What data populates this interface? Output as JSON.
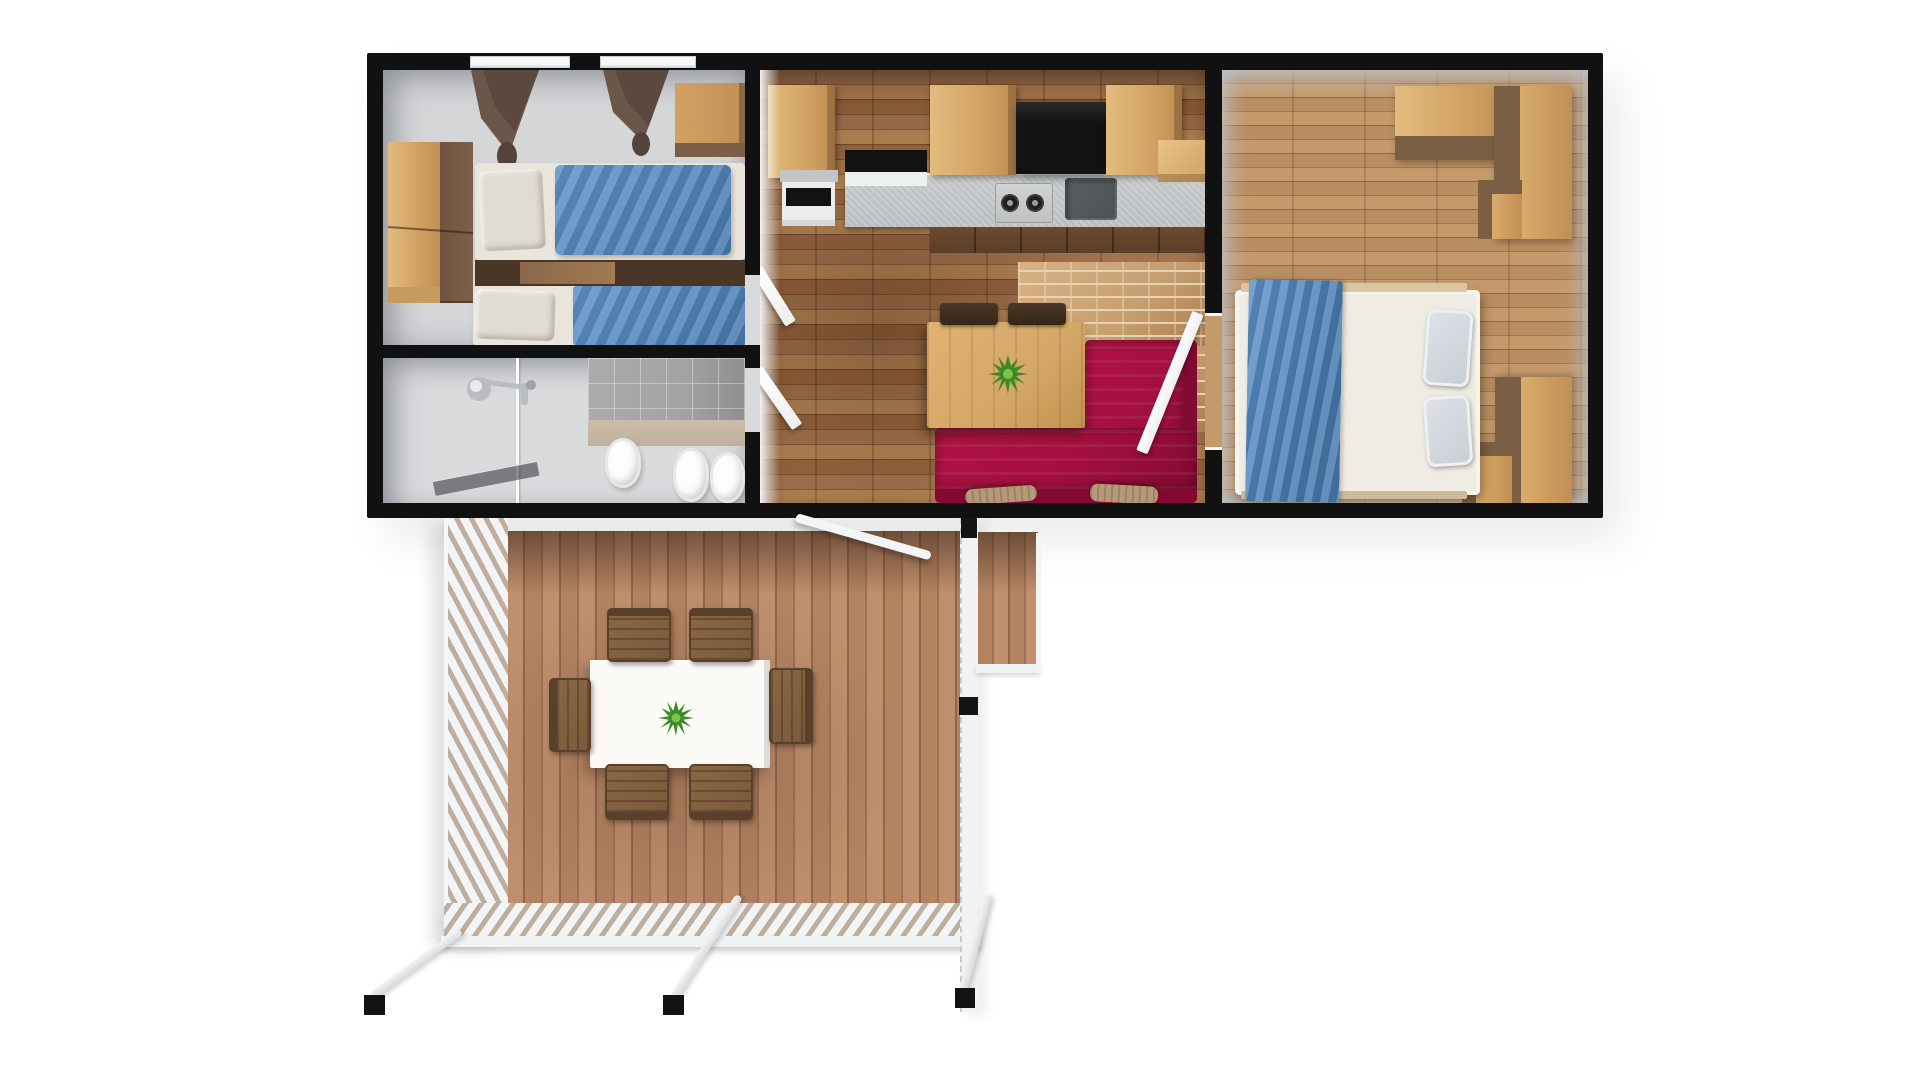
{
  "scene": {
    "type": "3d-floor-plan-render",
    "title": "Mobile home floor plan — top-down 3D render",
    "view": "top-down cutaway",
    "background": "#ffffff"
  },
  "colors": {
    "bg": "#ffffff",
    "wall": "#111111",
    "wall_face": "#d7dadd",
    "floor_gray": "#d5d6d8",
    "floor_bath": "#dadbdd",
    "wood": "#d2a263",
    "wood_light": "#e2bc7d",
    "wood_side": "#7b5f45",
    "wood_dark": "#5a3f28",
    "linen": "#eae5da",
    "pillow": "#e0dcd2",
    "blue": "#5e92c9",
    "blue_dark": "#4779ae",
    "curtain": "#6b564a",
    "curtain_dark": "#54433a",
    "tile": "#a3a3a3",
    "chrome": "#b9bdc0",
    "kf_a": "#a2744e",
    "kf_b": "#8a5c3a",
    "kf_c": "#b68655",
    "kf_d": "#6f4a2f",
    "counter": "#babec0",
    "black": "#121212",
    "sink": "#4d5255",
    "brick": "#c79e6f",
    "brick_line": "#e6d3b6",
    "sofa": "#a30f3e",
    "sofa_dark": "#820a30",
    "table_wood": "#d4a766",
    "plant": "#3b8a27",
    "plant_light": "#7fc24a",
    "b2f_a": "#b98e63",
    "b2f_b": "#a07750",
    "b2f_c": "#c59a6b",
    "b2f_d": "#8f6644",
    "duvet": "#efece3",
    "pillow_gray": "#c9cdd4",
    "deck_a": "#b38362",
    "deck_b": "#a17255",
    "deck_c": "#c08f6e",
    "deck_d": "#93664a",
    "lattice_slat": "#f3f4f5",
    "lattice_gap": "#bfae9d",
    "rail": "#f1f2f4",
    "chair_wood": "#7b5a3c",
    "chair_dark": "#59402a",
    "deck_table": "#fbfaf7",
    "pillow_tan": "#b69a78"
  },
  "unit": {
    "walls": "black cut-plane walls",
    "rooms": [
      {
        "id": "bedroom1",
        "name": "Twin Bedroom",
        "floor": "gray",
        "furniture": [
          "wardrobe",
          "overhead-cabinet",
          "twin-bed-upper",
          "twin-bed-lower",
          "nightstand",
          "two-windows-with-brown-curtains"
        ]
      },
      {
        "id": "bathroom",
        "name": "Bathroom",
        "floor": "light gray",
        "furniture": [
          "shower-head",
          "glass-partition",
          "shower-screen",
          "washbasin",
          "toilet",
          "bidet",
          "gray-wall-tiles"
        ]
      },
      {
        "id": "kitchen-living",
        "name": "Kitchen / Living Room",
        "floor": "brown wood planks",
        "furniture": [
          "tall-cabinet",
          "built-in-oven",
          "wall-cabinets",
          "range-hood",
          "gas-cooktop",
          "sink",
          "countertop",
          "lower-cabinets",
          "dining-table",
          "potted-plant",
          "two-chairs",
          "red-corner-sofa",
          "two-tan-pillows",
          "open-doors"
        ]
      },
      {
        "id": "bedroom2",
        "name": "Master Bedroom",
        "floor": "light wood planks",
        "furniture": [
          "double-bed",
          "blue-throw-blanket",
          "two-gray-pillows",
          "corner-wardrobe-top",
          "corner-wardrobe-bottom"
        ]
      }
    ]
  },
  "deck": {
    "id": "terrace",
    "name": "Wooden Terrace Deck",
    "furniture": [
      "white-outdoor-table",
      "potted-plant",
      "six-wooden-chairs",
      "lattice-railing-left",
      "lattice-railing-bottom",
      "right-railing",
      "entry-landing",
      "diagonal-handrail",
      "three-support-posts-with-black-caps"
    ]
  }
}
